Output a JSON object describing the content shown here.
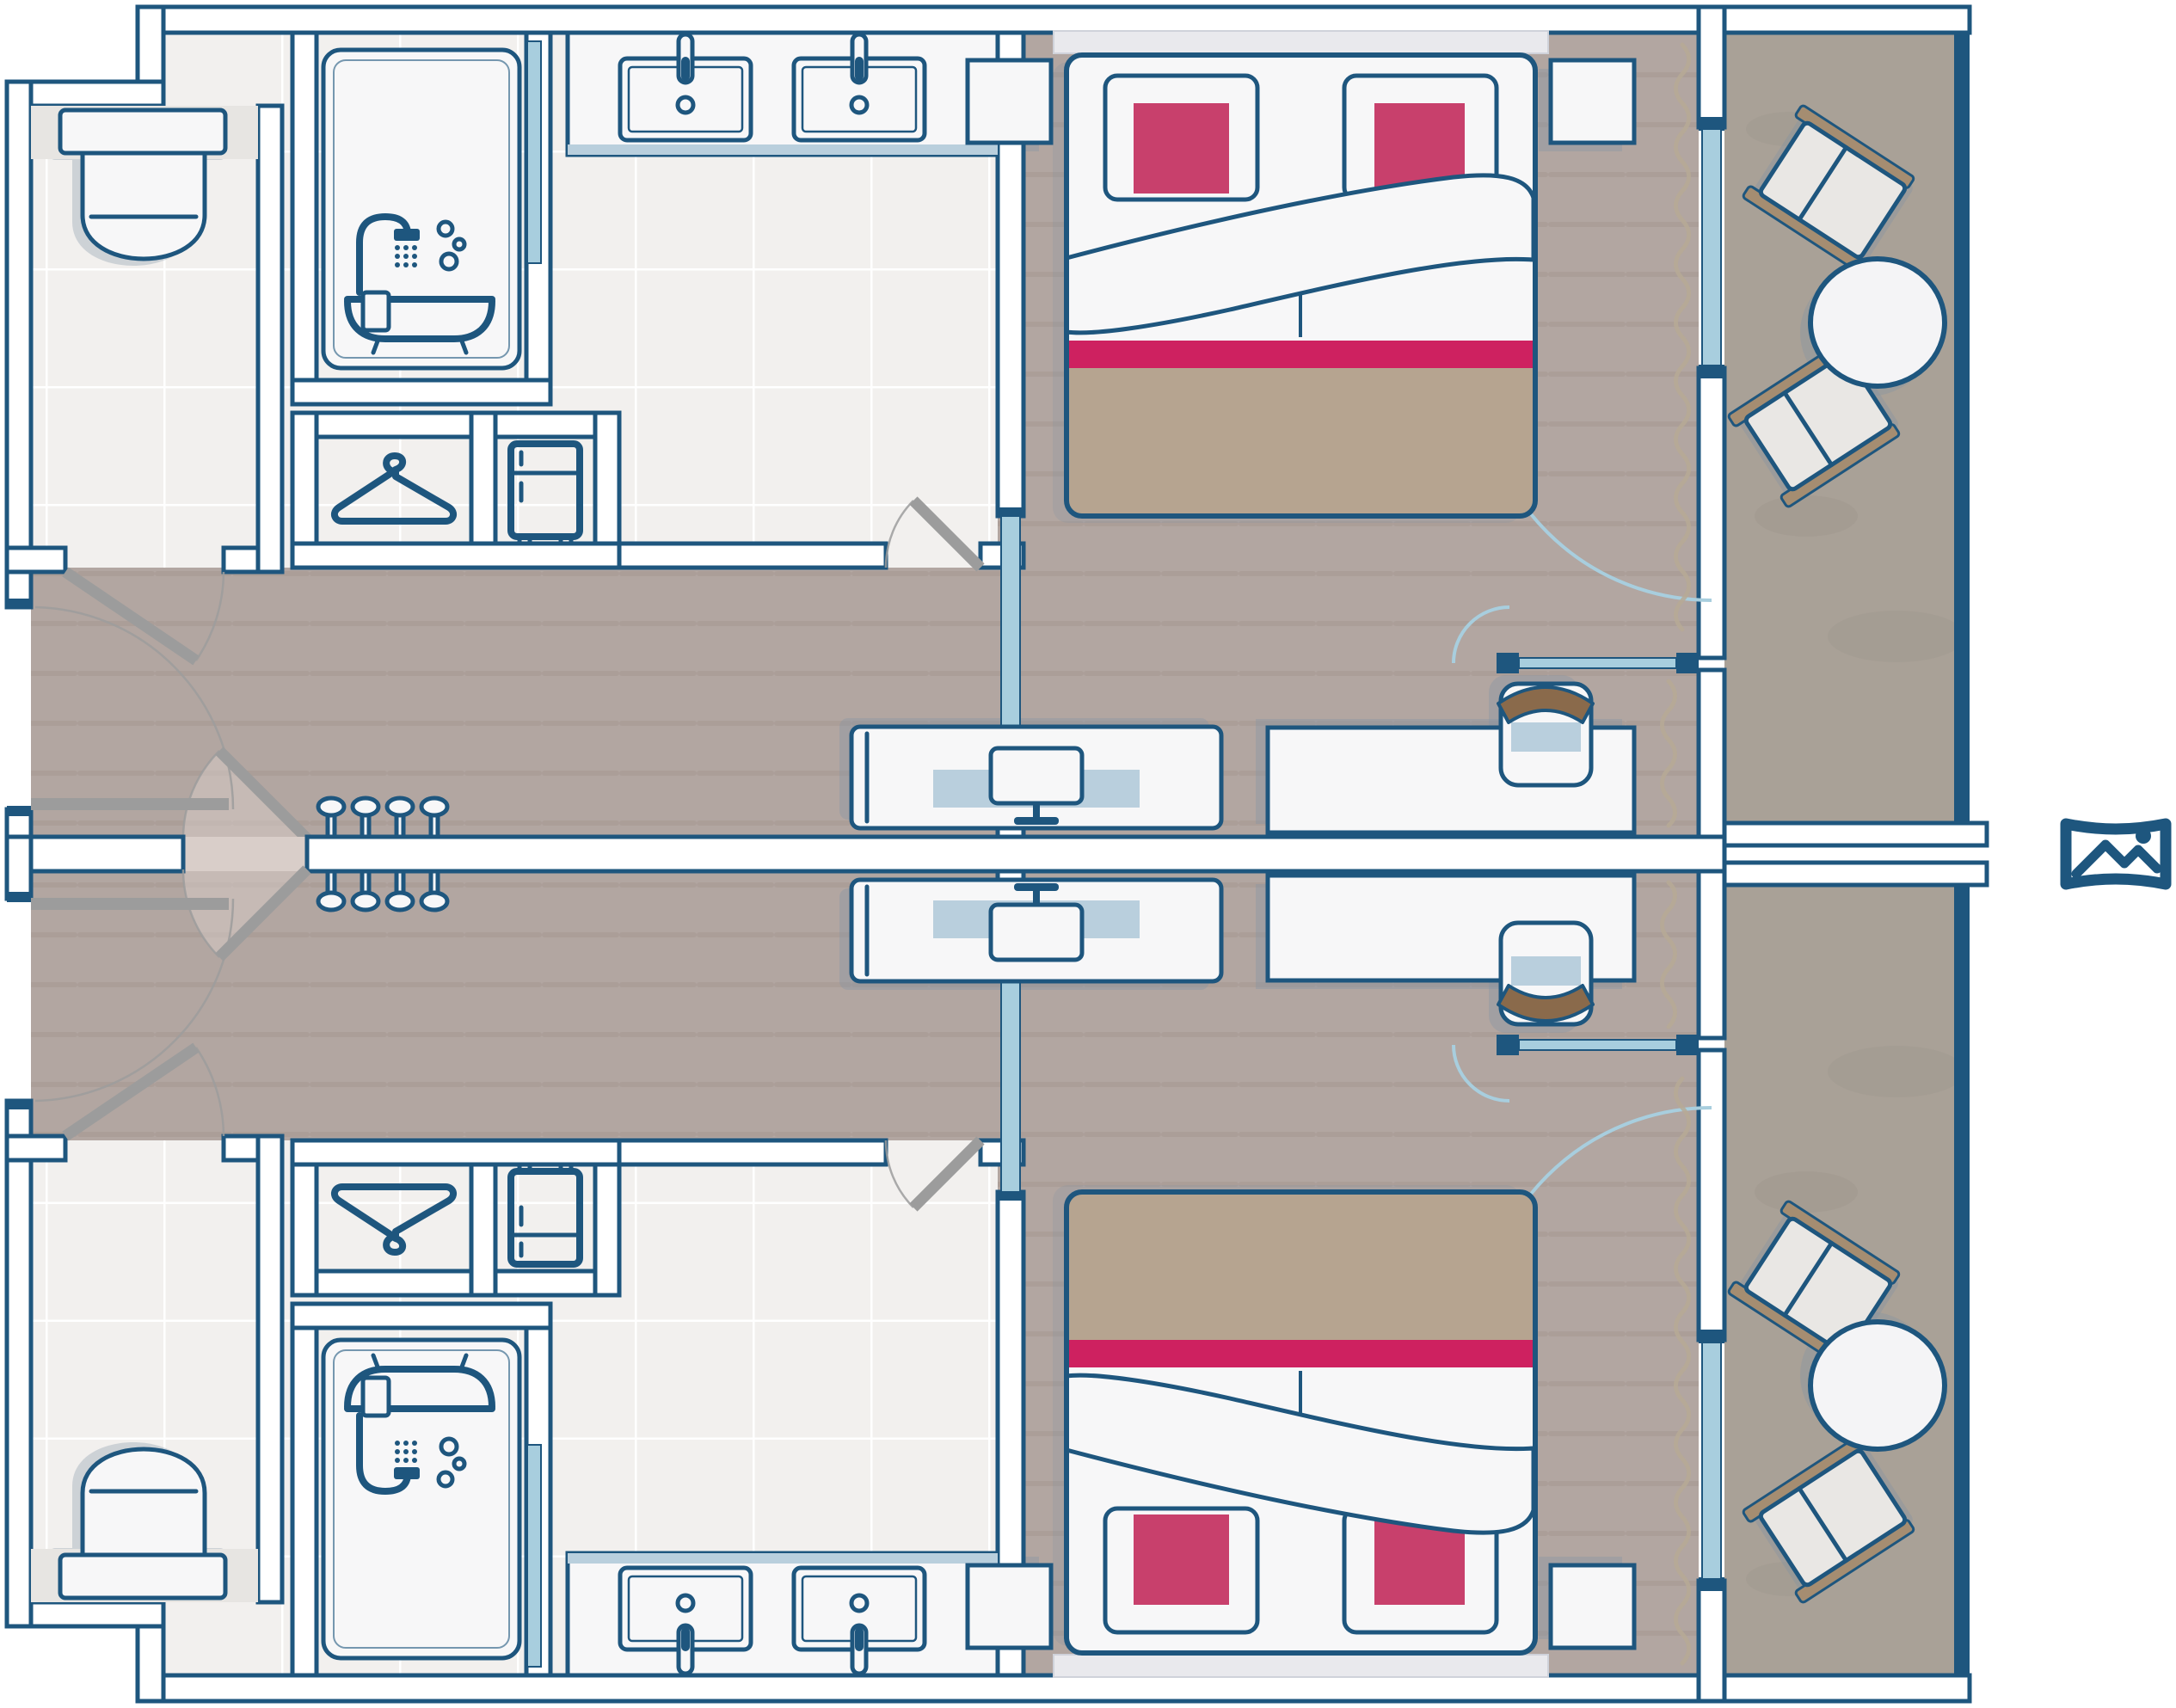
{
  "diagram": {
    "type": "floor-plan",
    "subject": "Two mirrored connecting hotel rooms with balconies",
    "units": [
      {
        "id": "room-a",
        "position": "top"
      },
      {
        "id": "room-b",
        "position": "bottom",
        "mirror_of": "room-a"
      }
    ],
    "rooms_per_unit": [
      "entry",
      "wc-toilet-room",
      "bathroom",
      "wardrobe-closet",
      "corridor",
      "bedroom",
      "study-nook",
      "balcony"
    ],
    "doors_per_unit": [
      "entry-door",
      "wc-door",
      "bathroom-door",
      "sliding-pocket-door",
      "connecting-double-door",
      "balcony-glass-door",
      "nook-glass-door"
    ],
    "view_marker": "panorama-view-icon"
  },
  "furniture_per_unit": {
    "bathroom": [
      "bathtub-with-shower",
      "double-sink-vanity",
      "toilet"
    ],
    "closet": [
      "hanger-wardrobe",
      "mini-fridge"
    ],
    "bedroom": [
      "double-bed",
      "pillow-left",
      "pillow-right",
      "nightstand-left",
      "nightstand-right",
      "tv-console",
      "tv",
      "desk",
      "office-chair",
      "coat-hooks-x4",
      "curtains"
    ],
    "balcony": [
      "round-table",
      "lounge-chair-x2"
    ]
  },
  "icons": [
    "shower-bath-icon",
    "hanger-icon",
    "fridge-icon",
    "tv-icon",
    "sink-faucet-icon",
    "coat-hook-icon",
    "panorama-view-icon"
  ],
  "palette": {
    "outline": "#1e567e",
    "wall_fill": "#ffffff",
    "glass": "#a8cede",
    "glass_soft": "#b9cfdd",
    "tile": "#f2f0ee",
    "wood": "#b2a6a1",
    "stripe": "#a3958f",
    "balcony": "#a9a197",
    "furn": "#f7f7f8",
    "pink": "#c8406c",
    "runner": "#ce2160",
    "taupe": "#b6a490",
    "brown": "#8a6a4b",
    "tan": "#a58d71",
    "door_grey": "#9c9c9c",
    "shadow": "#7e91a5",
    "headboard": "#e9e9ed",
    "curtain": "#b6a995",
    "threshold": "#d9cec9",
    "wc_band": "#e7e5e2"
  }
}
